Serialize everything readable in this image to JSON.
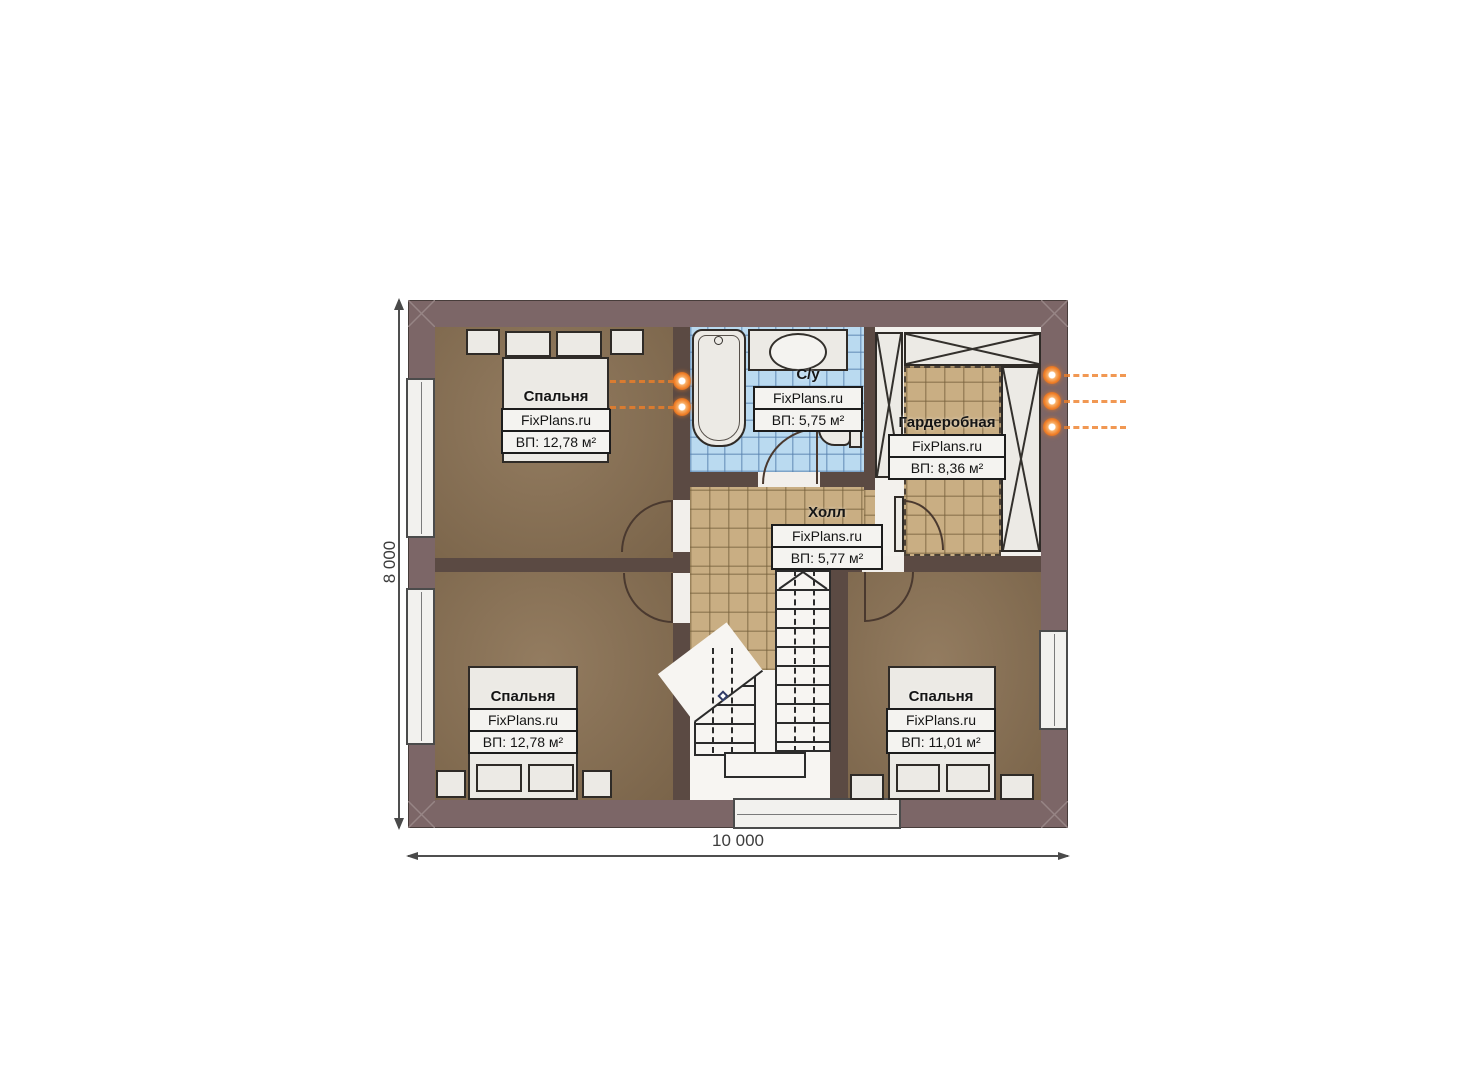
{
  "plan": {
    "type": "floor-plan",
    "dimensions": {
      "horizontal": "10 000",
      "vertical": "8 000"
    },
    "rooms": {
      "bedroom_tl": {
        "name": "Спальня",
        "brand": "FixPlans.ru",
        "area": "ВП: 12,78 м²"
      },
      "bathroom": {
        "name": "С/у",
        "brand": "FixPlans.ru",
        "area": "ВП: 5,75 м²"
      },
      "wardrobe": {
        "name": "Гардеробная",
        "brand": "FixPlans.ru",
        "area": "ВП: 8,36 м²"
      },
      "hall": {
        "name": "Холл",
        "brand": "FixPlans.ru",
        "area": "ВП: 5,77 м²"
      },
      "bedroom_bl": {
        "name": "Спальня",
        "brand": "FixPlans.ru",
        "area": "ВП: 12,78 м²"
      },
      "bedroom_br": {
        "name": "Спальня",
        "brand": "FixPlans.ru",
        "area": "ВП: 11,01 м²"
      }
    },
    "colors": {
      "exterior_wall": "#7c6667",
      "interior_wall": "#5b4a43",
      "wood_floor": "#8b7254",
      "tile_floor": "#c9ae83",
      "bath_tile": "#badaf0",
      "accent_orange": "#ee7a22"
    }
  }
}
